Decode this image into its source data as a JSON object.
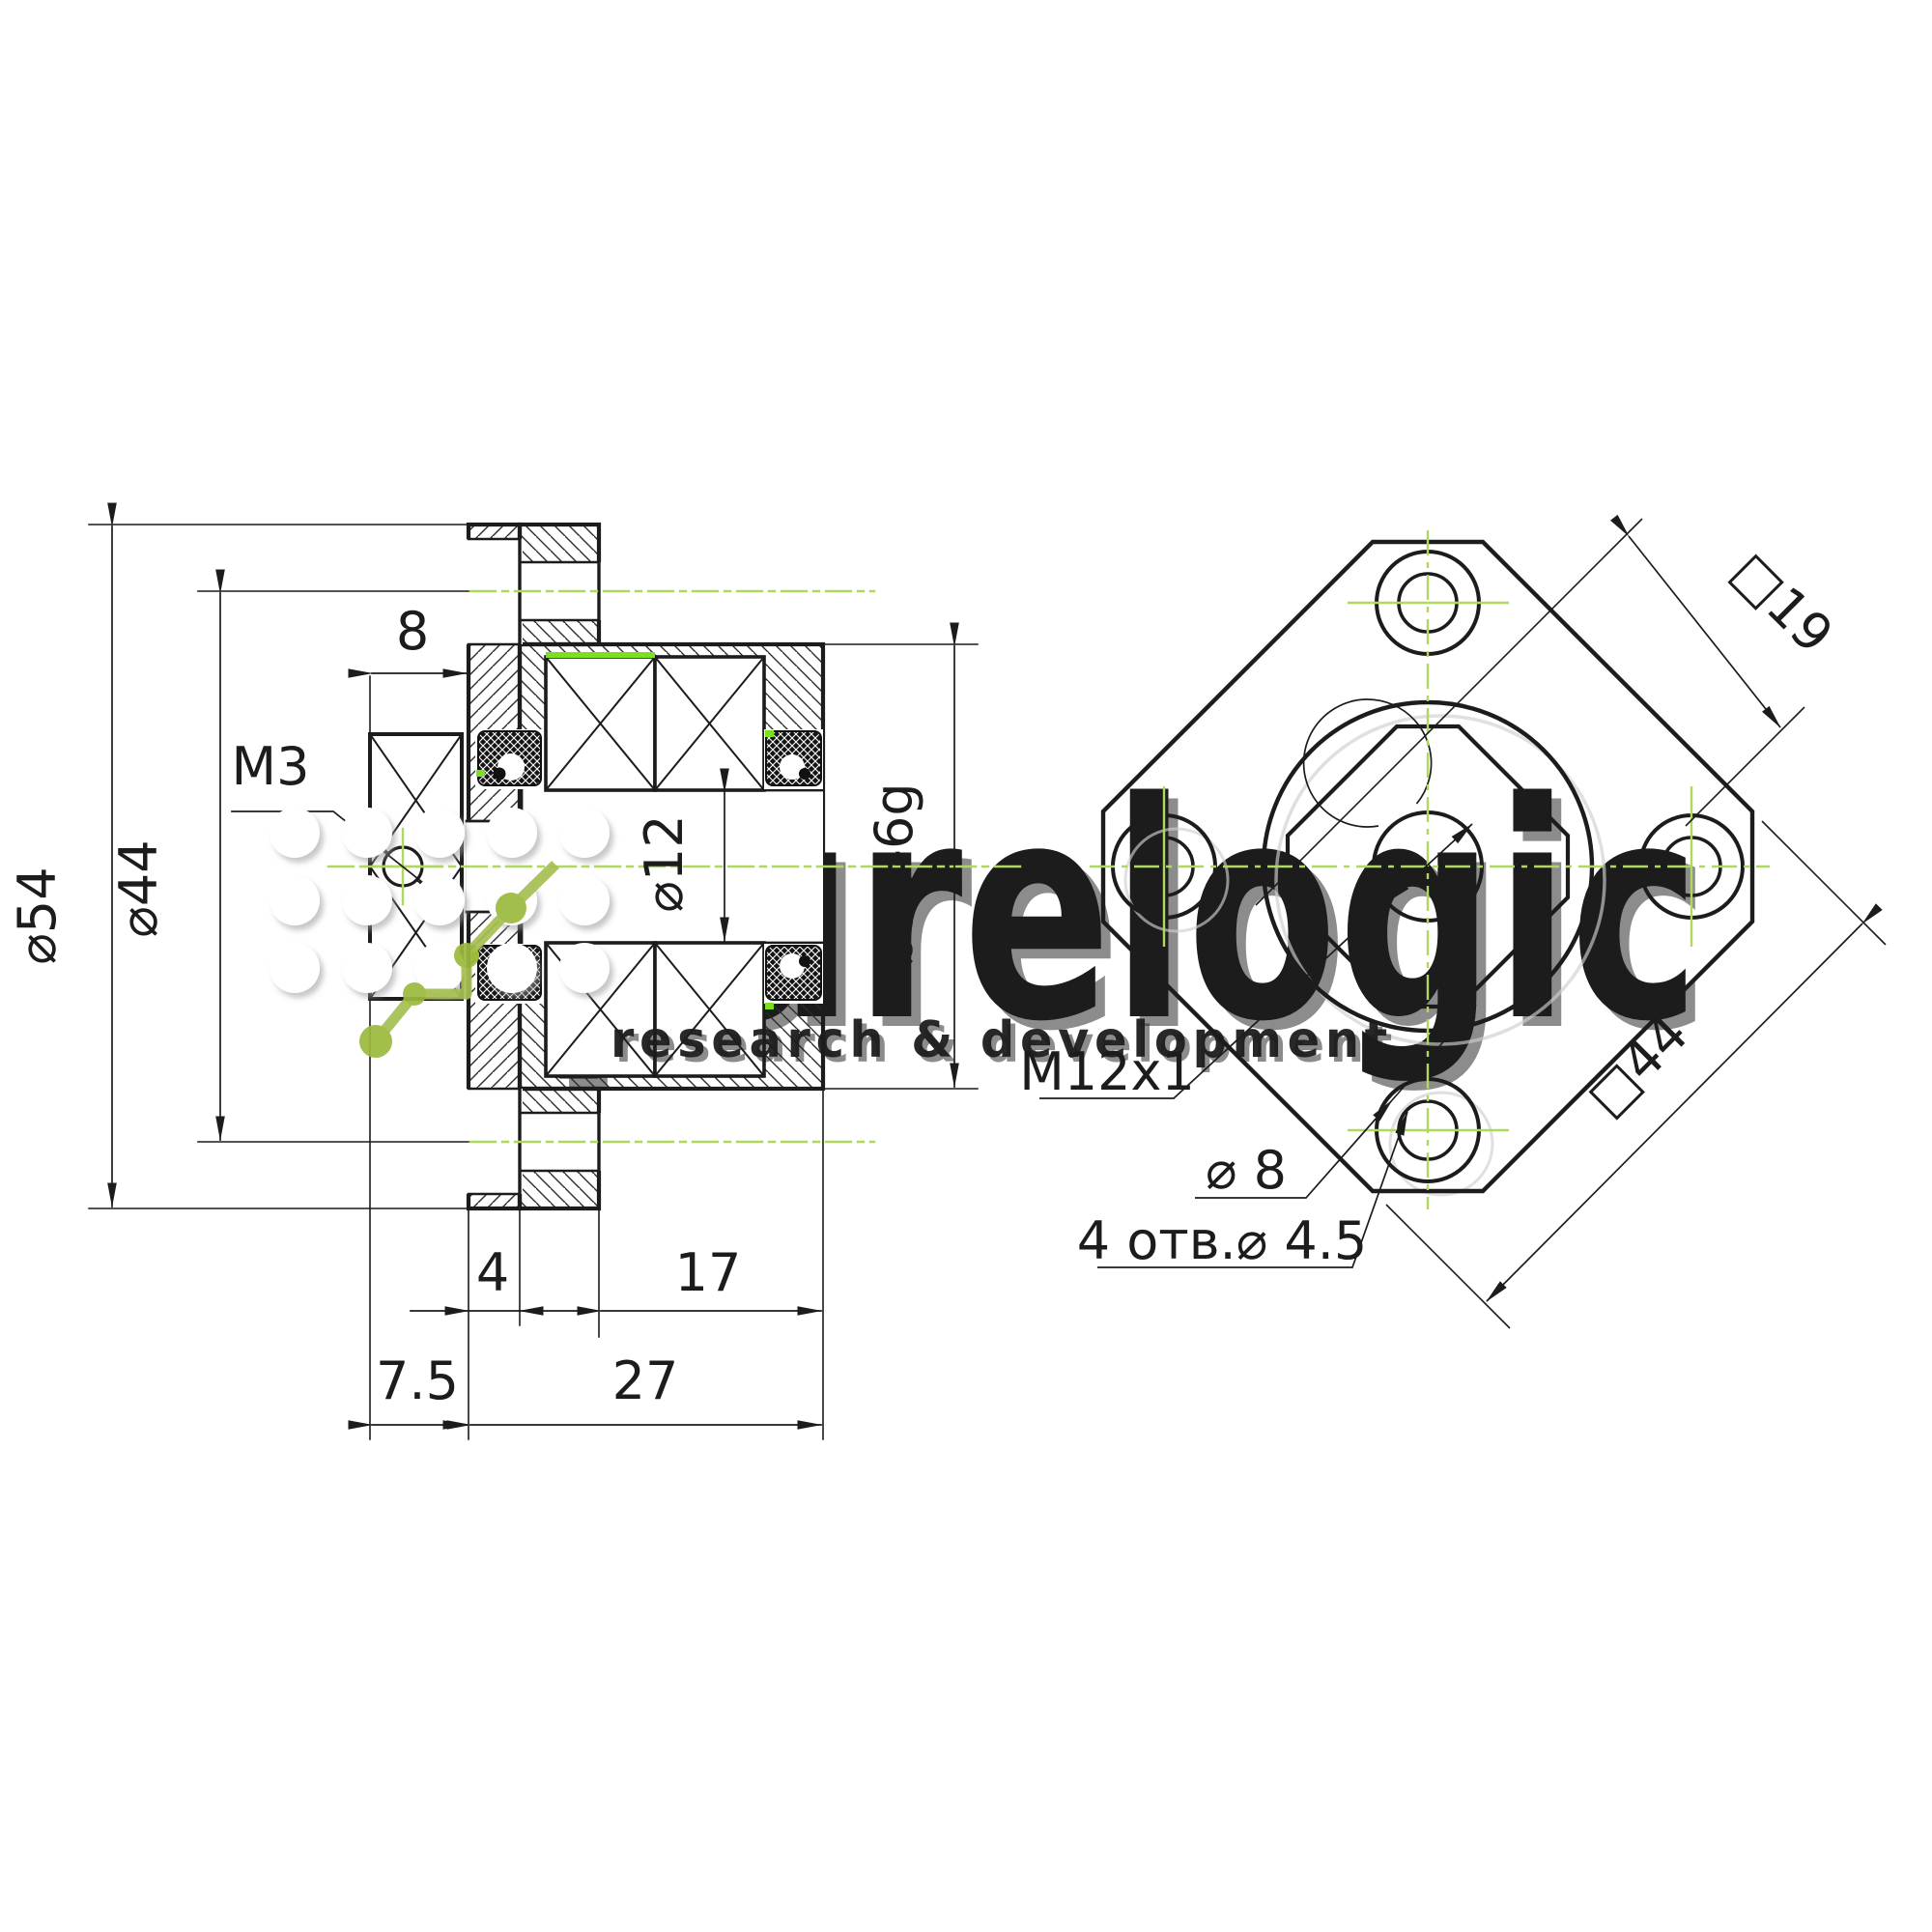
{
  "left_view": {
    "dia54": "⌀54",
    "dia44": "⌀44",
    "m3": "M3",
    "w8": "8",
    "dia12": "⌀12",
    "dia36": "⌀36-6g",
    "t4": "4",
    "t17": "17",
    "t75": "7.5",
    "t27": "27"
  },
  "right_view": {
    "sq19": "□19",
    "sq44": "□44",
    "m12": "M12x1",
    "dia8": "⌀ 8",
    "holes4": "4 отв.⌀ 4.5"
  },
  "watermark": {
    "brand": "purelogic",
    "tagline": "research & development"
  },
  "colors": {
    "line": "#1c1c1c",
    "centerline_green": "#aed95e",
    "highlight_green": "#7ce020",
    "logo_green": "#9cba3c",
    "background": "#ffffff"
  }
}
